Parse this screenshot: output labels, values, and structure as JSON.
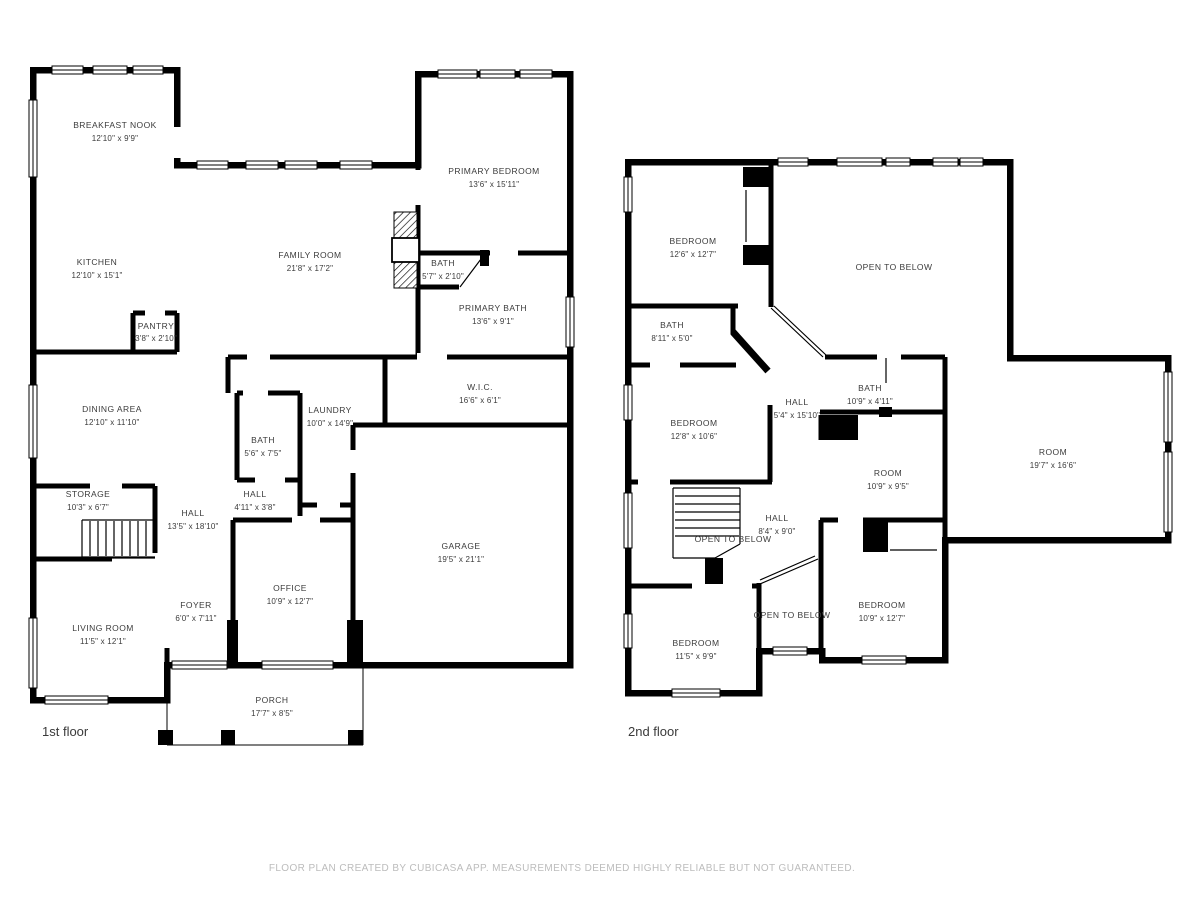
{
  "colors": {
    "wall": "#000000",
    "label": "#3b3b3b",
    "footer_text": "#bcbcbc",
    "background": "#ffffff"
  },
  "footer": {
    "text": "FLOOR PLAN CREATED BY CUBICASA APP. MEASUREMENTS DEEMED HIGHLY RELIABLE BUT NOT GUARANTEED."
  },
  "floors": [
    {
      "label": "1st floor",
      "rooms": [
        {
          "name": "BREAKFAST NOOK",
          "dims": "12'10\" x 9'9\""
        },
        {
          "name": "KITCHEN",
          "dims": "12'10\" x 15'1\""
        },
        {
          "name": "FAMILY ROOM",
          "dims": "21'8\" x 17'2\""
        },
        {
          "name": "PRIMARY BEDROOM",
          "dims": "13'6\" x 15'11\""
        },
        {
          "name": "BATH",
          "dims": "5'7\" x 2'10\""
        },
        {
          "name": "PRIMARY BATH",
          "dims": "13'6\" x 9'1\""
        },
        {
          "name": "PANTRY",
          "dims": "3'8\" x 2'10\""
        },
        {
          "name": "W.I.C.",
          "dims": "16'6\" x 6'1\""
        },
        {
          "name": "LAUNDRY",
          "dims": "10'0\" x 14'9\""
        },
        {
          "name": "BATH",
          "dims": "5'6\" x 7'5\""
        },
        {
          "name": "HALL",
          "dims": "4'11\" x 3'8\""
        },
        {
          "name": "DINING AREA",
          "dims": "12'10\" x 11'10\""
        },
        {
          "name": "STORAGE",
          "dims": "10'3\" x 6'7\""
        },
        {
          "name": "HALL",
          "dims": "13'5\" x 18'10\""
        },
        {
          "name": "FOYER",
          "dims": "6'0\" x 7'11\""
        },
        {
          "name": "LIVING ROOM",
          "dims": "11'5\" x 12'1\""
        },
        {
          "name": "OFFICE",
          "dims": "10'9\" x 12'7\""
        },
        {
          "name": "GARAGE",
          "dims": "19'5\" x 21'1\""
        },
        {
          "name": "PORCH",
          "dims": "17'7\" x 8'5\""
        }
      ]
    },
    {
      "label": "2nd floor",
      "rooms": [
        {
          "name": "BEDROOM",
          "dims": "12'6\" x 12'7\""
        },
        {
          "name": "OPEN TO BELOW",
          "dims": ""
        },
        {
          "name": "BATH",
          "dims": "8'11\" x 5'0\""
        },
        {
          "name": "BEDROOM",
          "dims": "12'8\" x 10'6\""
        },
        {
          "name": "HALL",
          "dims": "5'4\" x 15'10\""
        },
        {
          "name": "BATH",
          "dims": "10'9\" x 4'11\""
        },
        {
          "name": "ROOM",
          "dims": "10'9\" x 9'5\""
        },
        {
          "name": "ROOM",
          "dims": "19'7\" x 16'6\""
        },
        {
          "name": "HALL",
          "dims": "8'4\" x 9'0\""
        },
        {
          "name": "OPEN TO BELOW",
          "dims": ""
        },
        {
          "name": "OPEN TO BELOW",
          "dims": ""
        },
        {
          "name": "BEDROOM",
          "dims": "11'5\" x 9'9\""
        },
        {
          "name": "BEDROOM",
          "dims": "10'9\" x 12'7\""
        }
      ]
    }
  ]
}
